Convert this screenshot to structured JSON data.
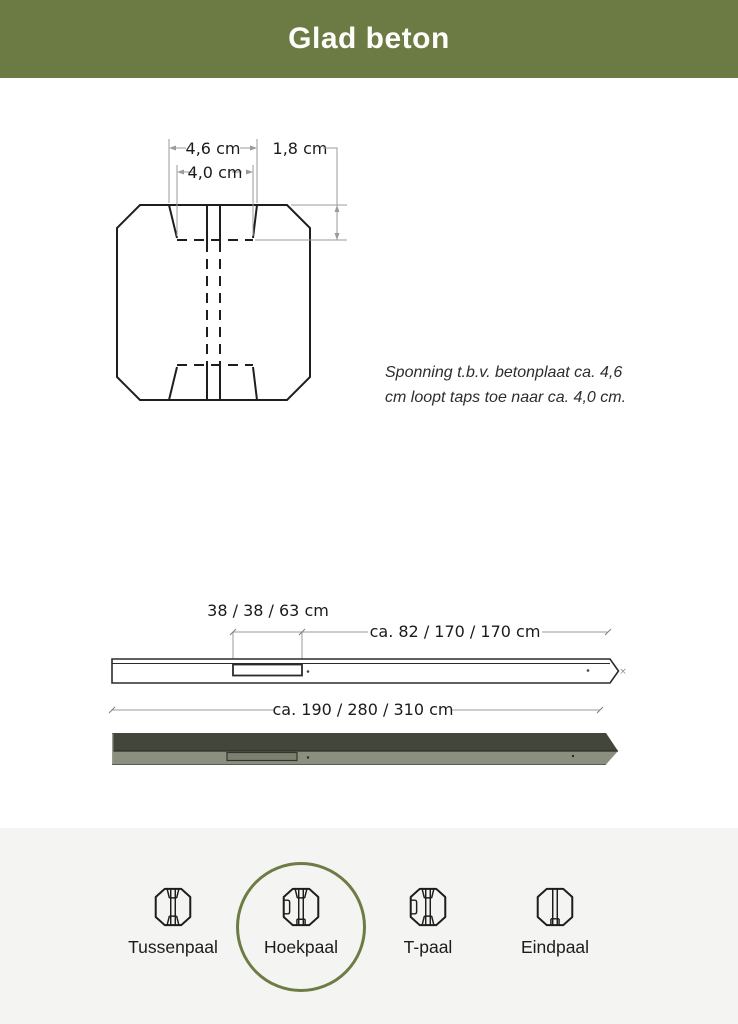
{
  "header": {
    "title": "Glad beton"
  },
  "colors": {
    "header_bg": "#6c7a43",
    "accent_ring": "#6d7c44",
    "footer_bg": "#f4f4f2",
    "post_top_face": "#42463b",
    "post_front_face": "#8b8f7e",
    "drawing_line": "#1e1e1e",
    "dimension_line": "#9b9b9b"
  },
  "cross_section": {
    "dim_width_top": "4,6 cm",
    "dim_width_bottom": "4,0 cm",
    "dim_depth": "1,8 cm",
    "note_lines": [
      "Sponning t.b.v. betonplaat ca. 4,6",
      "cm loopt taps toe naar ca. 4,0 cm."
    ]
  },
  "side_view": {
    "dim_sponning_length": "38 / 38 / 63 cm",
    "dim_upper_length": "ca. 82 / 170  / 170 cm",
    "dim_total_length": "ca. 190 / 280 / 310 cm",
    "tip_mark": "×"
  },
  "post_types": {
    "selected": "Hoekpaal",
    "items": [
      {
        "label": "Tussenpaal",
        "icon": "tussenpaal-cross-section-icon"
      },
      {
        "label": "Hoekpaal",
        "icon": "hoekpaal-cross-section-icon"
      },
      {
        "label": "T-paal",
        "icon": "t-paaal-cross-section-icon"
      },
      {
        "label": "Eindpaal",
        "icon": "eindpaal-cross-section-icon"
      }
    ]
  }
}
